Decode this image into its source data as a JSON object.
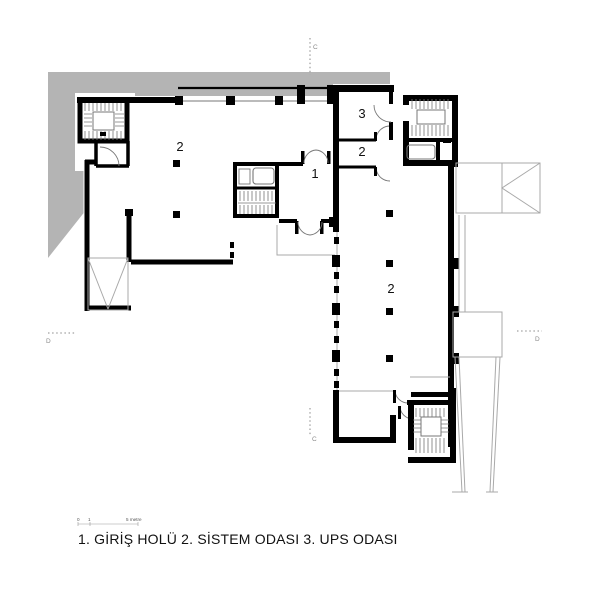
{
  "plan": {
    "caption": "1. GİRİŞ HOLÜ 2. SİSTEM ODASI 3. UPS ODASI",
    "rooms": [
      {
        "name": "entrance-hall",
        "label": "1"
      },
      {
        "name": "system-room-west",
        "label": "2"
      },
      {
        "name": "ups-room",
        "label": "3"
      },
      {
        "name": "system-room-upper",
        "label": "2"
      },
      {
        "name": "system-room-east",
        "label": "2"
      }
    ],
    "section_markers": {
      "top": "C",
      "bottom": "C",
      "left": "D",
      "right": "D"
    },
    "scale_bar": {
      "tick_zero": "0",
      "tick_one": "1",
      "tick_end": "5 metre"
    },
    "colors": {
      "wall": "#000000",
      "site": "#b4b4b4",
      "thin": "#a9a9a9",
      "mid": "#777777",
      "text": "#111111",
      "marker": "#8a8a8a"
    }
  }
}
